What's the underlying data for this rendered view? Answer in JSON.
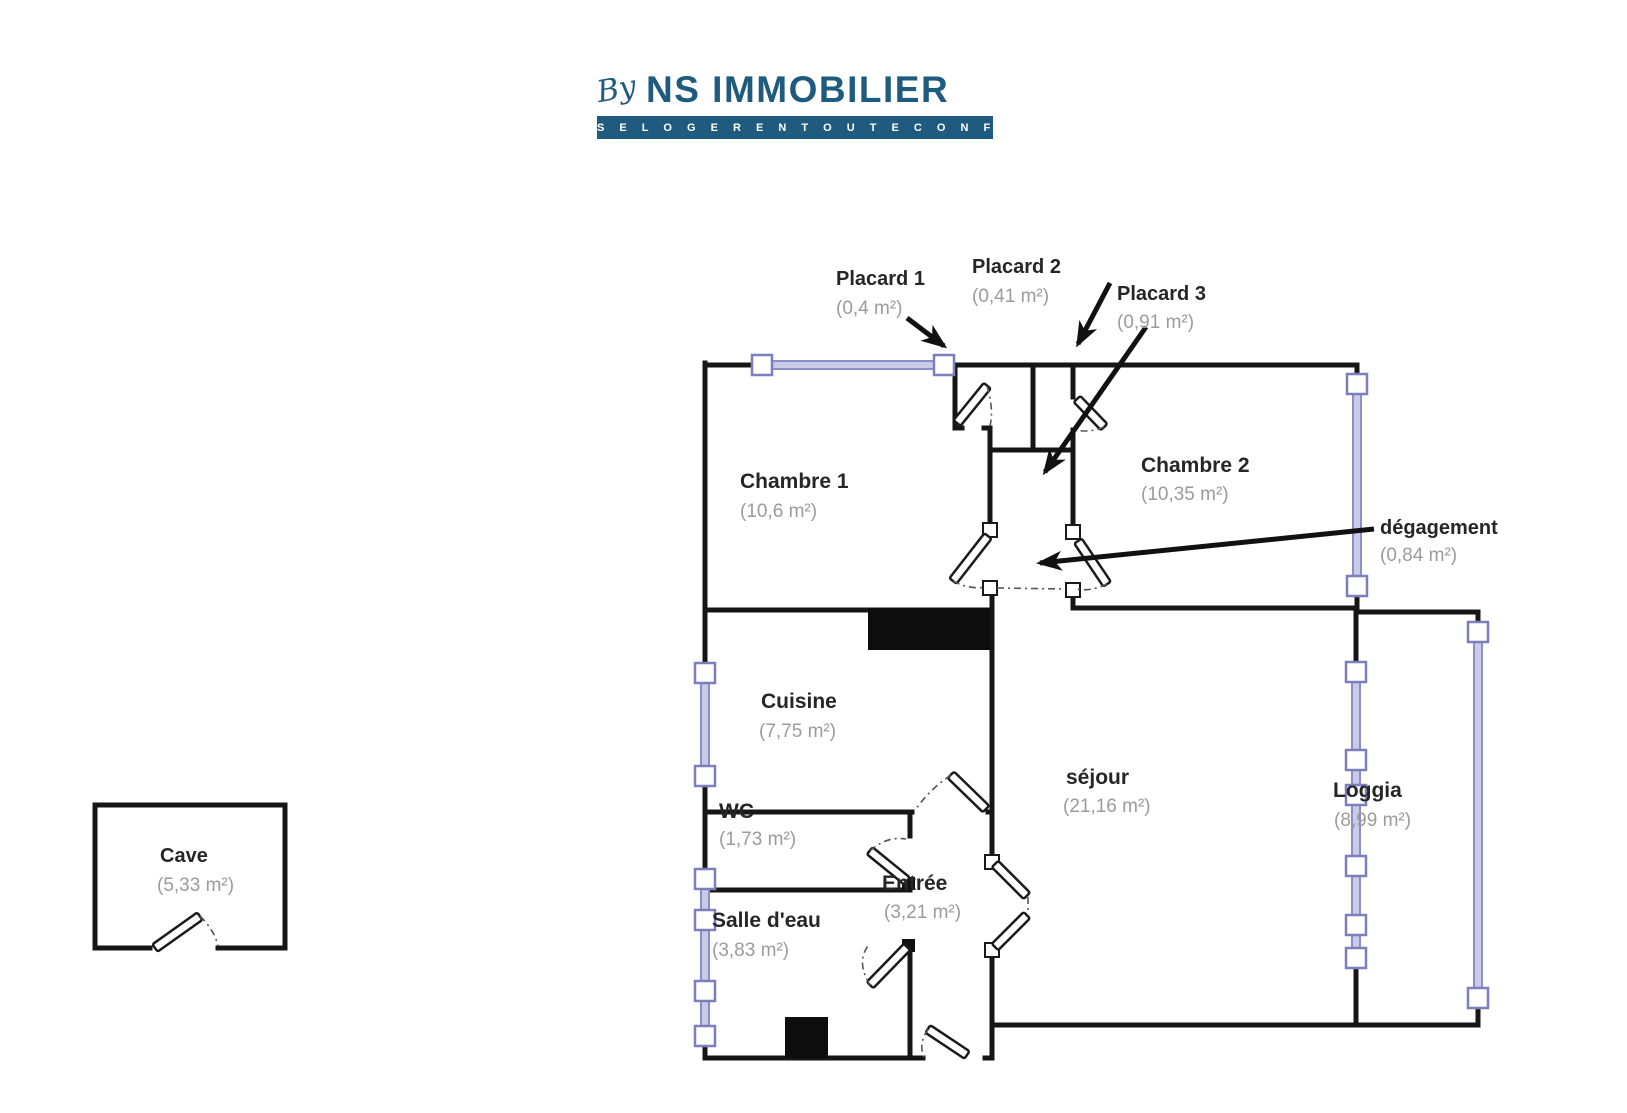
{
  "logo": {
    "by": "By",
    "name": "NS IMMOBILIER",
    "tagline": "S E   L O G E R   E N   T O U T E   C O N F I A N C E",
    "brand_color": "#1e5b7e"
  },
  "plan": {
    "wall_color": "#161616",
    "window_color": "#8a8fc8",
    "label_color": "#262626",
    "area_color": "#9b9b9b",
    "rooms": [
      {
        "name": "Chambre 1",
        "area": "(10,6 m²)"
      },
      {
        "name": "Chambre 2",
        "area": "(10,35 m²)"
      },
      {
        "name": "Cuisine",
        "area": "(7,75 m²)"
      },
      {
        "name": "WC",
        "area": "(1,73 m²)"
      },
      {
        "name": "Salle d'eau",
        "area": "(3,83 m²)"
      },
      {
        "name": "Entrée",
        "area": "(3,21 m²)"
      },
      {
        "name": "séjour",
        "area": "(21,16 m²)"
      },
      {
        "name": "Loggia",
        "area": "(8,99 m²)"
      },
      {
        "name": "dégagement",
        "area": "(0,84 m²)"
      },
      {
        "name": "Placard 1",
        "area": "(0,4 m²)"
      },
      {
        "name": "Placard 2",
        "area": "(0,41 m²)"
      },
      {
        "name": "Placard 3",
        "area": "(0,91 m²)"
      },
      {
        "name": "Cave",
        "area": "(5,33 m²)"
      }
    ]
  }
}
